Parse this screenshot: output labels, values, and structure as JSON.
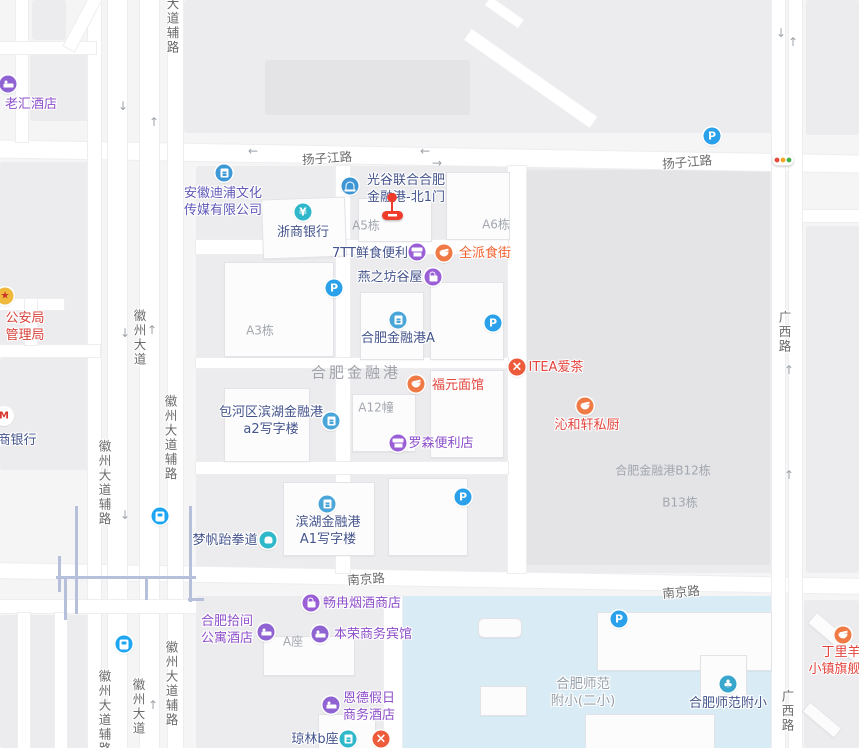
{
  "map": {
    "colors": {
      "navy": "#44548c",
      "violet": "#5f58b8",
      "purple": "#8d4fc9",
      "red": "#e2453e",
      "orange": "#f2622f",
      "police": "#d8403a",
      "gray": "#97a0aa",
      "area_label": "#a2a7ae",
      "big_area_label": "#9fa3a9",
      "road_label": "#6b6b6b",
      "parking_blue": "#2aa1ea",
      "marker_red": "#ee3b2b",
      "school_fill": "#d9ecf5"
    },
    "pois": [
      {
        "id": "laohui-hotel",
        "lines": [
          "老汇酒店"
        ],
        "color": "purple",
        "x": 31,
        "y": 104
      },
      {
        "id": "police-bureau",
        "lines": [
          "公安局",
          "管理局"
        ],
        "color": "police",
        "x": 25,
        "y": 318
      },
      {
        "id": "cmb-bank",
        "lines": [
          "商银行"
        ],
        "color": "navy",
        "x": 17,
        "y": 440
      },
      {
        "id": "anhui-dipu-media",
        "lines": [
          "安徽迪浦文化",
          "传媒有限公司"
        ],
        "color": "violet",
        "x": 223,
        "y": 193
      },
      {
        "id": "zheshang-bank",
        "lines": [
          "浙商银行"
        ],
        "color": "navy",
        "x": 303,
        "y": 232
      },
      {
        "id": "guanggu-north-gate1",
        "lines": [
          "光谷联合合肥",
          "金融港-北1门"
        ],
        "color": "navy",
        "x": 406,
        "y": 180
      },
      {
        "id": "7tt-fresh-store",
        "lines": [
          "7TT鲜食便利"
        ],
        "color": "navy",
        "x": 370,
        "y": 253
      },
      {
        "id": "quanpai-food-street",
        "lines": [
          "全派食街"
        ],
        "color": "orange",
        "x": 485,
        "y": 253
      },
      {
        "id": "yanzhifang-guwu",
        "lines": [
          "燕之坊谷屋"
        ],
        "color": "navy",
        "x": 390,
        "y": 277
      },
      {
        "id": "hefei-financial-port-a",
        "lines": [
          "合肥金融港A"
        ],
        "color": "navy",
        "x": 398,
        "y": 338
      },
      {
        "id": "itea-tea",
        "lines": [
          "ITEA爱茶"
        ],
        "color": "red",
        "x": 556,
        "y": 367
      },
      {
        "id": "fuyuan-noodle",
        "lines": [
          "福元面馆"
        ],
        "color": "red",
        "x": 458,
        "y": 385
      },
      {
        "id": "qinhexuan-kitchen",
        "lines": [
          "沁和轩私厨"
        ],
        "color": "red",
        "x": 587,
        "y": 425
      },
      {
        "id": "baohe-a2-office",
        "lines": [
          "包河区滨湖金融港",
          "a2写字楼"
        ],
        "color": "navy",
        "x": 271,
        "y": 412
      },
      {
        "id": "lawson-store",
        "lines": [
          "罗森便利店"
        ],
        "color": "purple",
        "x": 441,
        "y": 443
      },
      {
        "id": "binhu-a1-office",
        "lines": [
          "滨湖金融港",
          "A1写字楼"
        ],
        "color": "navy",
        "x": 328,
        "y": 522
      },
      {
        "id": "mengfan-taekwondo",
        "lines": [
          "梦帆跆拳道"
        ],
        "color": "navy",
        "x": 225,
        "y": 540
      },
      {
        "id": "changran-tobacco-shop",
        "lines": [
          "畅冉烟酒商店"
        ],
        "color": "purple",
        "x": 362,
        "y": 603
      },
      {
        "id": "hefei-shijian-apartment-hotel",
        "lines": [
          "合肥拾间",
          "公寓酒店"
        ],
        "color": "purple",
        "x": 227,
        "y": 621
      },
      {
        "id": "benrong-hotel",
        "lines": [
          "本荣商务宾馆"
        ],
        "color": "purple",
        "x": 373,
        "y": 634
      },
      {
        "id": "ende-holiday-hotel",
        "lines": [
          "恩德假日",
          "商务酒店"
        ],
        "color": "purple",
        "x": 369,
        "y": 698
      },
      {
        "id": "qionglin-b",
        "lines": [
          "琼林b座"
        ],
        "color": "navy",
        "x": 315,
        "y": 739
      },
      {
        "id": "hefei-normal-primary",
        "lines": [
          "合肥师范附小"
        ],
        "color": "navy",
        "x": 728,
        "y": 703
      },
      {
        "id": "dingliyang-flagship",
        "lines": [
          "丁里羊",
          "小镇旗舰店"
        ],
        "color": "red",
        "x": 841,
        "y": 652
      },
      {
        "id": "hefei-normal-primary-2",
        "lines": [
          "合肥师范",
          "附小(二小)"
        ],
        "color": "gray",
        "x": 583,
        "y": 684,
        "size": 13.5
      }
    ],
    "area_labels": [
      {
        "id": "hefei-financial-port",
        "text": "合肥金融港",
        "x": 356,
        "y": 372,
        "size": 15,
        "ls": 3,
        "big": true
      },
      {
        "id": "a5-bldg",
        "text": "A5栋",
        "x": 366,
        "y": 225
      },
      {
        "id": "a6-bldg",
        "text": "A6栋",
        "x": 496,
        "y": 224
      },
      {
        "id": "a3-bldg",
        "text": "A3栋",
        "x": 260,
        "y": 330
      },
      {
        "id": "a12-bldg",
        "text": "A12幢",
        "x": 376,
        "y": 407
      },
      {
        "id": "b12-bldg",
        "text": "合肥金融港B12栋",
        "x": 663,
        "y": 470
      },
      {
        "id": "b13-bldg",
        "text": "B13栋",
        "x": 680,
        "y": 502
      },
      {
        "id": "a-block",
        "text": "A座",
        "x": 293,
        "y": 641
      }
    ],
    "road_labels": [
      {
        "text": "扬子江路",
        "x": 327,
        "y": 157,
        "rot": -4
      },
      {
        "text": "扬子江路",
        "x": 687,
        "y": 161,
        "rot": -5
      },
      {
        "text": "南京路",
        "x": 366,
        "y": 578,
        "rot": -4
      },
      {
        "text": "南京路",
        "x": 681,
        "y": 591,
        "rot": -5
      },
      {
        "text": "大道辅路",
        "x": 172,
        "y": 26,
        "vertical": true
      },
      {
        "text": "徽州大道",
        "x": 139,
        "y": 338,
        "vertical": true
      },
      {
        "text": "徽州大道辅路",
        "x": 170,
        "y": 438,
        "vertical": true
      },
      {
        "text": "徽州大道辅路",
        "x": 104,
        "y": 483,
        "vertical": true
      },
      {
        "text": "徽州大道",
        "x": 138,
        "y": 707,
        "vertical": true
      },
      {
        "text": "徽州大道辅路",
        "x": 104,
        "y": 713,
        "vertical": true
      },
      {
        "text": "徽州大道辅路",
        "x": 171,
        "y": 684,
        "vertical": true
      },
      {
        "text": "广西路",
        "x": 784,
        "y": 332,
        "vertical": true
      },
      {
        "text": "广西路",
        "x": 787,
        "y": 711,
        "vertical": true
      }
    ],
    "icons": [
      {
        "type": "hotel",
        "name": "hotel-icon",
        "x": 8,
        "y": 84
      },
      {
        "type": "police",
        "name": "police-badge-icon",
        "x": 5,
        "y": 296
      },
      {
        "type": "cmb",
        "name": "merchants-bank-icon",
        "x": 4,
        "y": 416
      },
      {
        "type": "company",
        "name": "company-icon",
        "x": 224,
        "y": 173
      },
      {
        "type": "yen",
        "name": "bank-yen-icon",
        "x": 303,
        "y": 212
      },
      {
        "type": "gate",
        "name": "gate-entrance-icon",
        "x": 350,
        "y": 186
      },
      {
        "type": "store",
        "name": "convenience-store-icon",
        "x": 417,
        "y": 252
      },
      {
        "type": "bowl",
        "name": "restaurant-bowl-icon",
        "x": 444,
        "y": 253
      },
      {
        "type": "bag",
        "name": "shopping-bag-icon",
        "x": 433,
        "y": 277
      },
      {
        "type": "parking",
        "name": "parking-icon",
        "x": 334,
        "y": 288
      },
      {
        "type": "bldgblue",
        "name": "office-building-icon",
        "x": 398,
        "y": 320
      },
      {
        "type": "parking",
        "name": "parking-icon",
        "x": 493,
        "y": 323
      },
      {
        "type": "fork",
        "name": "restaurant-cutlery-icon",
        "x": 517,
        "y": 367
      },
      {
        "type": "bowl",
        "name": "restaurant-bowl-icon",
        "x": 416,
        "y": 384
      },
      {
        "type": "bowl",
        "name": "restaurant-bowl-icon",
        "x": 585,
        "y": 406
      },
      {
        "type": "bldgblue",
        "name": "office-building-icon",
        "x": 331,
        "y": 421
      },
      {
        "type": "store",
        "name": "convenience-store-icon",
        "x": 398,
        "y": 443
      },
      {
        "type": "parking",
        "name": "parking-icon",
        "x": 463,
        "y": 497
      },
      {
        "type": "bldgblue",
        "name": "office-building-icon",
        "x": 327,
        "y": 504
      },
      {
        "type": "transit",
        "name": "bus-station-icon",
        "x": 160,
        "y": 516
      },
      {
        "type": "martial",
        "name": "martial-arts-icon",
        "x": 268,
        "y": 540
      },
      {
        "type": "bag",
        "name": "shopping-bag-icon",
        "x": 311,
        "y": 603
      },
      {
        "type": "hotel",
        "name": "hotel-icon",
        "x": 266,
        "y": 632
      },
      {
        "type": "hotel",
        "name": "hotel-icon",
        "x": 320,
        "y": 634
      },
      {
        "type": "parking",
        "name": "parking-icon",
        "x": 619,
        "y": 619
      },
      {
        "type": "hotel",
        "name": "hotel-icon",
        "x": 331,
        "y": 705
      },
      {
        "type": "bldgteal",
        "name": "building-icon",
        "x": 348,
        "y": 739
      },
      {
        "type": "fork",
        "name": "restaurant-cutlery-icon",
        "x": 381,
        "y": 739
      },
      {
        "type": "leaf",
        "name": "school-icon",
        "x": 728,
        "y": 684
      },
      {
        "type": "bowl",
        "name": "restaurant-bowl-icon",
        "x": 843,
        "y": 635
      },
      {
        "type": "parking",
        "name": "parking-icon",
        "x": 712,
        "y": 136
      },
      {
        "type": "traffic",
        "name": "traffic-light-icon",
        "x": 783,
        "y": 160
      },
      {
        "type": "transit",
        "name": "bus-station-icon",
        "x": 124,
        "y": 644
      },
      {
        "type": "marker",
        "name": "destination-marker-icon",
        "x": 392,
        "y": 207
      }
    ],
    "arrows": [
      {
        "dir": "↓",
        "x": 123,
        "y": 106
      },
      {
        "dir": "↑",
        "x": 154,
        "y": 122
      },
      {
        "dir": "←",
        "x": 253,
        "y": 151
      },
      {
        "dir": "←",
        "x": 425,
        "y": 151
      },
      {
        "dir": "→",
        "x": 437,
        "y": 163
      },
      {
        "dir": "↓",
        "x": 125,
        "y": 333
      },
      {
        "dir": "↑",
        "x": 152,
        "y": 330
      },
      {
        "dir": "↓",
        "x": 125,
        "y": 515
      },
      {
        "dir": "↑",
        "x": 153,
        "y": 705
      },
      {
        "dir": "↓",
        "x": 781,
        "y": 33
      },
      {
        "dir": "↑",
        "x": 793,
        "y": 42
      },
      {
        "dir": "↑",
        "x": 789,
        "y": 370
      },
      {
        "dir": "↑",
        "x": 789,
        "y": 475
      }
    ]
  }
}
